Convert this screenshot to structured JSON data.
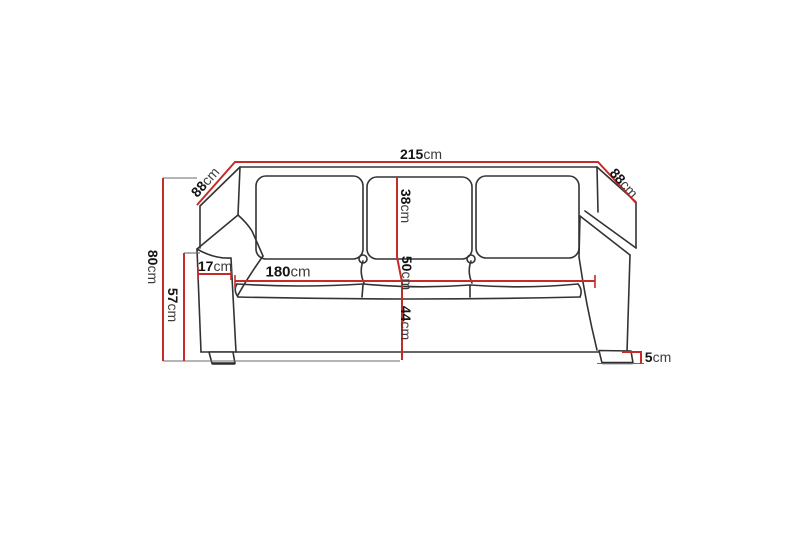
{
  "diagram": {
    "subject": "three-seat sofa dimension drawing",
    "colors": {
      "dimension-line": "#c62b27",
      "outline": "#333333",
      "background": "#ffffff"
    },
    "dimensions": {
      "total_width": {
        "value": "215",
        "unit": "cm"
      },
      "depth_left": {
        "value": "88",
        "unit": "cm"
      },
      "depth_right": {
        "value": "88",
        "unit": "cm"
      },
      "total_height": {
        "value": "80",
        "unit": "cm"
      },
      "arm_height": {
        "value": "57",
        "unit": "cm"
      },
      "arm_width": {
        "value": "17",
        "unit": "cm"
      },
      "seat_width": {
        "value": "180",
        "unit": "cm"
      },
      "backrest_height": {
        "value": "38",
        "unit": "cm"
      },
      "seat_depth": {
        "value": "50",
        "unit": "cm"
      },
      "seat_height": {
        "value": "44",
        "unit": "cm"
      },
      "leg_height": {
        "value": "5",
        "unit": "cm"
      }
    }
  }
}
